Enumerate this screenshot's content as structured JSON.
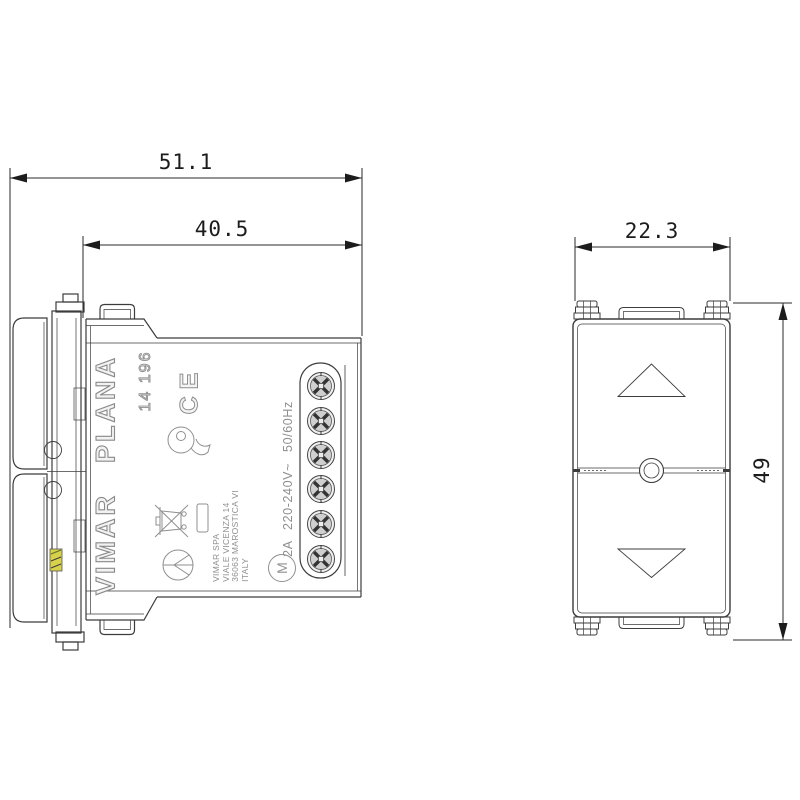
{
  "title": "Vimar Plana flush-mounted roller shutter switch technical drawing",
  "dimensions": {
    "overall_depth": "51.1",
    "recess_depth": "40.5",
    "module_width": "22.3",
    "module_height": "49"
  },
  "side_view": {
    "brand": "VIMAR",
    "series": "PLANA",
    "model": "14 196",
    "ce_mark": "CE",
    "ratings": "2A 220-240V~ 50/60Hz",
    "motor_symbol": "M",
    "address_lines": [
      "VIMAR SPA",
      "VIALE VICENZA 14",
      "36063 MAROSTICA VI",
      "ITALY"
    ]
  },
  "icons": {
    "screw_terminal": "screw-terminal-icon",
    "weee_bin": "weee-crossed-bin-icon",
    "imq_mark": "imq-quality-mark-icon",
    "cert_circle": "certification-circle-icon",
    "up_arrow": "up-arrow-icon",
    "down_arrow": "down-arrow-icon"
  },
  "colors": {
    "line": "#3c3c3c",
    "thin_line": "#6f6f6f",
    "label_gray": "#8f8f8f",
    "dimension_text": "#1c1c1c",
    "screw_fill": "#d6d6d6",
    "latch_yellow": "#cfc44a",
    "latch_green": "#6f7f2e",
    "background": "#ffffff"
  }
}
